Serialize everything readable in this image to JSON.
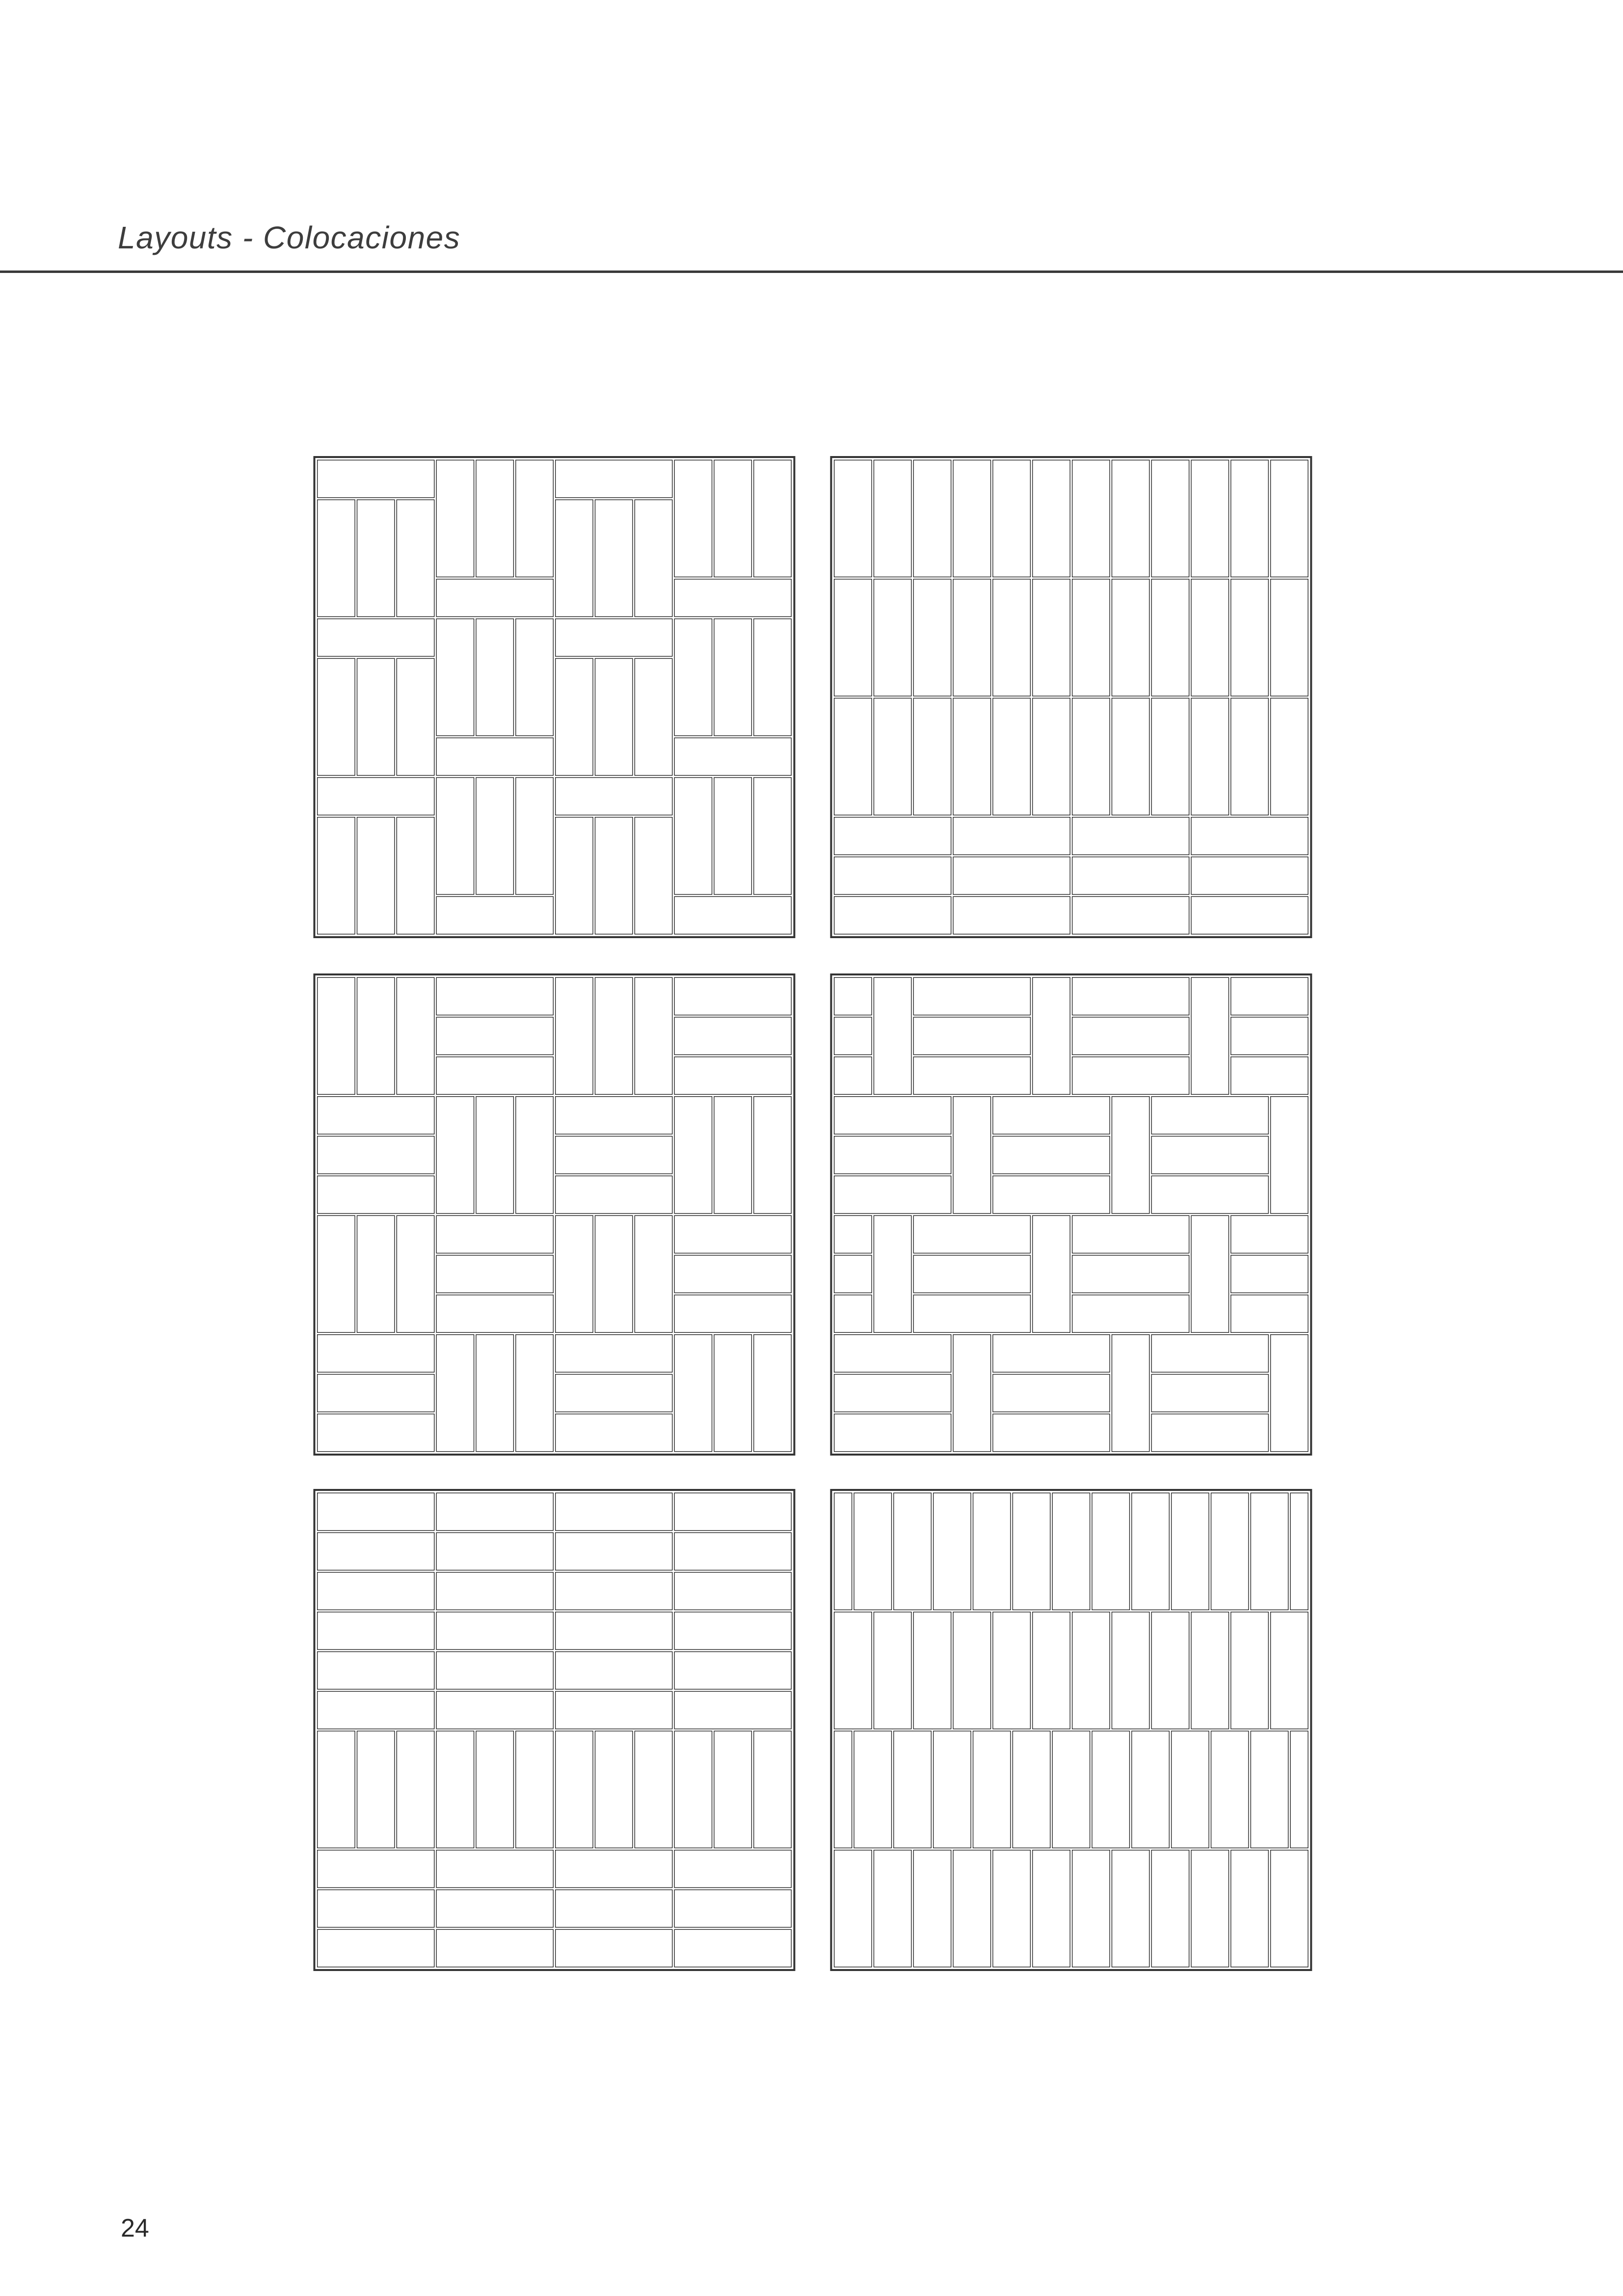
{
  "page": {
    "title": "Layouts - Colocaciones",
    "page_number": "24"
  },
  "styles": {
    "background": "#ffffff",
    "title_color": "#3d3d3d",
    "rule_color": "#3a3a3a",
    "page_number_color": "#2a2a2a",
    "panel_border_color": "#343434",
    "tile_line_color": "#1f1f1f",
    "tile_fill": "#ffffff"
  },
  "tile_system": {
    "tile_ratio": "1:3",
    "modules_per_panel_side": 12,
    "panel_grid": {
      "rows": 3,
      "cols": 2
    }
  },
  "panels": [
    {
      "name": "panel-alternating-column-stack",
      "pattern": "alt_columns",
      "position": "top-left",
      "description": "Four columns of repeating units: one horizontal tile above three vertical tiles; alternate columns flip the unit order"
    },
    {
      "name": "panel-stacked-verticals-horizontal-base",
      "pattern": "stacked_bands",
      "position": "top-right",
      "description": "Three aligned courses of twelve vertical tiles above three aligned courses of four horizontal tiles"
    },
    {
      "name": "panel-basketweave",
      "pattern": "basketweave",
      "position": "middle-left",
      "description": "4x4 checkerboard of blocks made of three vertical or three horizontal tiles"
    },
    {
      "name": "panel-pier-and-panel-offset",
      "pattern": "pier_and_panel",
      "position": "middle-right",
      "description": "Rows of three stacked horizontal tiles separated by single vertical tiles; alternate rows offset half a block"
    },
    {
      "name": "panel-horizontal-stack-vertical-course",
      "pattern": "stack_with_soldier_course",
      "position": "bottom-left",
      "description": "Six stacked horizontal courses, one course of twelve vertical tiles, then three stacked horizontal courses"
    },
    {
      "name": "panel-vertical-running-bond",
      "pattern": "vertical_running_bond",
      "position": "bottom-right",
      "description": "Four courses of vertical tiles; alternate courses offset by half a tile width"
    }
  ]
}
